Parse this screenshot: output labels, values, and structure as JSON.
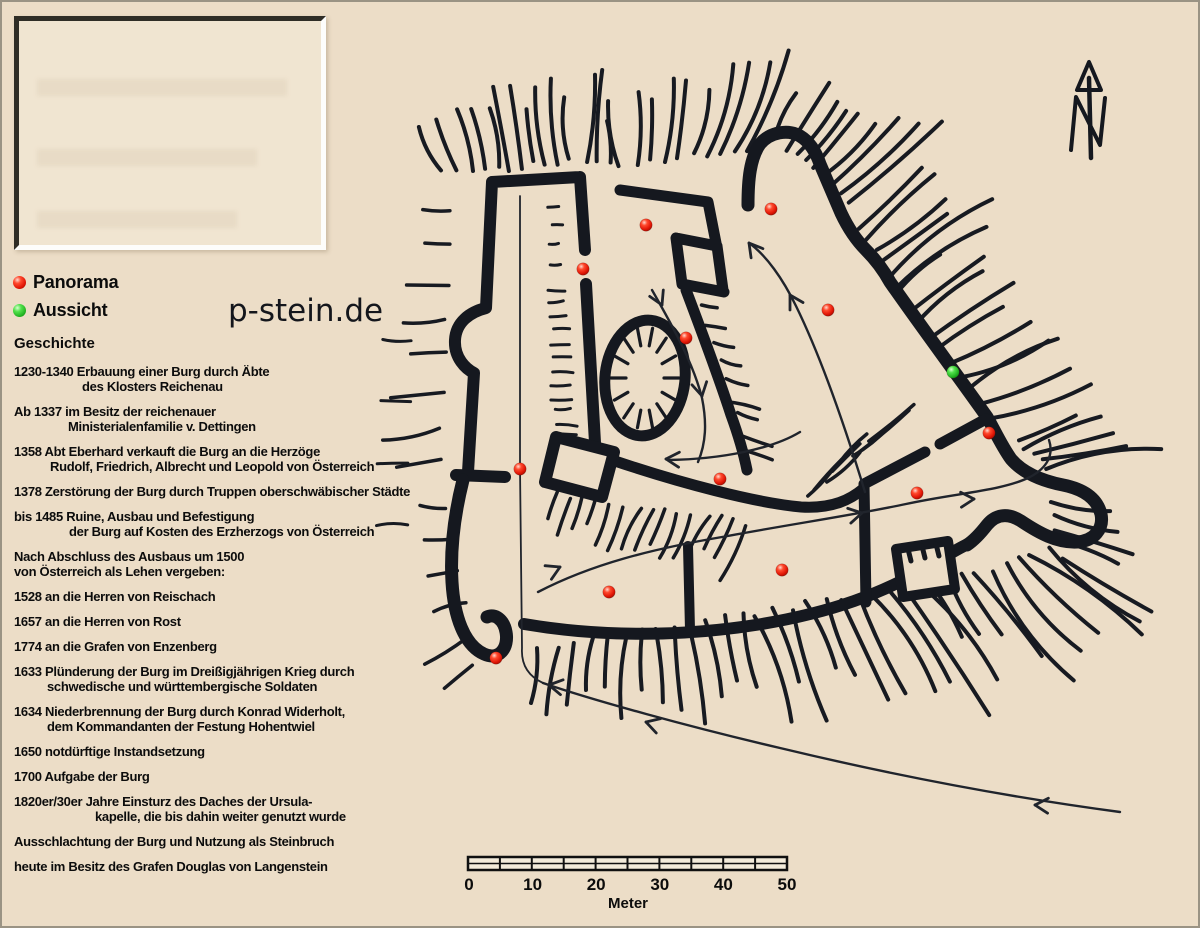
{
  "site": {
    "name": "p-stein.de"
  },
  "legend": {
    "items": [
      {
        "label": "Panorama",
        "color": "#e3180b"
      },
      {
        "label": "Aussicht",
        "color": "#35d435"
      }
    ]
  },
  "history": {
    "title": "Geschichte",
    "entries": [
      {
        "lines": [
          {
            "text": "1230-1340 Erbauung einer Burg durch Äbte",
            "indent": 0
          },
          {
            "text": "des Klosters Reichenau",
            "indent": 68
          }
        ]
      },
      {
        "lines": [
          {
            "text": "Ab 1337 im Besitz der reichenauer",
            "indent": 0
          },
          {
            "text": "Ministerialenfamilie v. Dettingen",
            "indent": 54
          }
        ]
      },
      {
        "lines": [
          {
            "text": "1358 Abt Eberhard verkauft die Burg an die Herzöge",
            "indent": 0
          },
          {
            "text": "Rudolf, Friedrich, Albrecht und Leopold von Österreich",
            "indent": 36
          }
        ]
      },
      {
        "lines": [
          {
            "text": "1378 Zerstörung der Burg durch Truppen oberschwäbischer Städte",
            "indent": 0
          }
        ]
      },
      {
        "lines": [
          {
            "text": "bis 1485 Ruine, Ausbau und Befestigung",
            "indent": 0
          },
          {
            "text": "der Burg auf Kosten des Erzherzogs von Österreich",
            "indent": 55
          }
        ]
      },
      {
        "lines": [
          {
            "text": "Nach Abschluss des Ausbaus um 1500",
            "indent": 0
          },
          {
            "text": "von Österreich als Lehen vergeben:",
            "indent": 0
          }
        ]
      },
      {
        "lines": [
          {
            "text": "1528 an die Herren von Reischach",
            "indent": 0
          }
        ]
      },
      {
        "lines": [
          {
            "text": "1657 an die Herren von Rost",
            "indent": 0
          }
        ]
      },
      {
        "lines": [
          {
            "text": "1774 an die Grafen von Enzenberg",
            "indent": 0
          }
        ]
      },
      {
        "lines": [
          {
            "text": "1633 Plünderung der Burg im Dreißigjährigen Krieg durch",
            "indent": 0
          },
          {
            "text": "schwedische und württembergische Soldaten",
            "indent": 33
          }
        ]
      },
      {
        "lines": [
          {
            "text": "1634 Niederbrennung der Burg durch Konrad Widerholt,",
            "indent": 0
          },
          {
            "text": "dem Kommandanten der Festung Hohentwiel",
            "indent": 33
          }
        ]
      },
      {
        "lines": [
          {
            "text": "1650 notdürftige Instandsetzung",
            "indent": 0
          }
        ]
      },
      {
        "lines": [
          {
            "text": "1700 Aufgabe der Burg",
            "indent": 0
          }
        ]
      },
      {
        "lines": [
          {
            "text": "1820er/30er Jahre Einsturz des Daches der Ursula-",
            "indent": 0
          },
          {
            "text": "kapelle, die bis dahin weiter genutzt wurde",
            "indent": 81
          }
        ]
      },
      {
        "lines": [
          {
            "text": "Ausschlachtung der Burg und Nutzung als Steinbruch",
            "indent": 0
          }
        ]
      },
      {
        "lines": [
          {
            "text": "heute im Besitz des Grafen Douglas von Langenstein",
            "indent": 0
          }
        ]
      }
    ]
  },
  "scalebar": {
    "labels": [
      "0",
      "10",
      "20",
      "30",
      "40",
      "50"
    ],
    "unit": "Meter"
  },
  "map": {
    "north_label": "N",
    "colors": {
      "wall": "#15181f",
      "panorama": "#e3180b",
      "aussicht": "#35d435",
      "background": "#ecddc7"
    },
    "dots": {
      "panorama": [
        {
          "x": 771,
          "y": 209
        },
        {
          "x": 646,
          "y": 225
        },
        {
          "x": 583,
          "y": 269
        },
        {
          "x": 828,
          "y": 310
        },
        {
          "x": 686,
          "y": 338
        },
        {
          "x": 989,
          "y": 433
        },
        {
          "x": 520,
          "y": 469
        },
        {
          "x": 720,
          "y": 479
        },
        {
          "x": 917,
          "y": 493
        },
        {
          "x": 782,
          "y": 570
        },
        {
          "x": 609,
          "y": 592
        },
        {
          "x": 496,
          "y": 658
        }
      ],
      "aussicht": [
        {
          "x": 953,
          "y": 372
        }
      ]
    }
  }
}
